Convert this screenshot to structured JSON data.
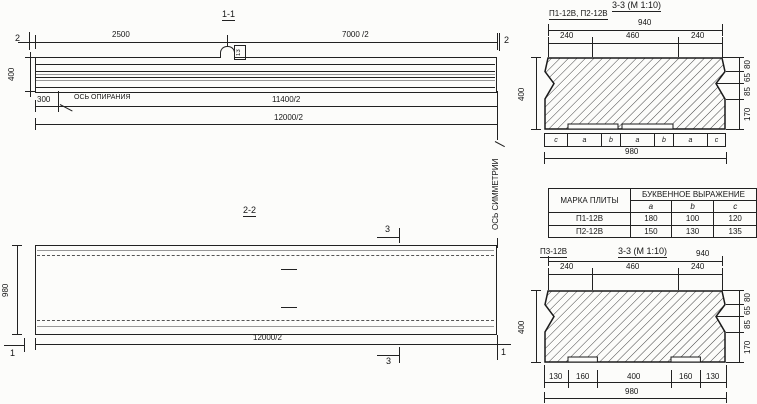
{
  "s11": {
    "title": "1-1",
    "dim_2500": "2500",
    "dim_7000": "7000 /2",
    "dim_400": "400",
    "dim_300": "300",
    "support_axis": "ОСЬ ОПИРАНИЯ",
    "dim_11400": "11400/2",
    "dim_12000": "12000/2",
    "marker_left": "2",
    "marker_right": "2",
    "loop_tag": "13",
    "symmetry_axis": "ОСЬ СИММЕТРИИ"
  },
  "s22": {
    "title": "2-2",
    "dim_980": "980",
    "dim_12000": "12000/2",
    "marker_3": "3",
    "marker_1": "1"
  },
  "s33a": {
    "title": "3-3 (М 1:10)",
    "label": "П1-12В, П2-12В",
    "dim_940": "940",
    "dims_top": [
      "240",
      "460",
      "240"
    ],
    "dim_400": "400",
    "dims_right": [
      "80",
      "65",
      "85",
      "170"
    ],
    "letters": [
      "c",
      "a",
      "b",
      "a",
      "b",
      "a",
      "c"
    ],
    "dim_980": "980"
  },
  "table": {
    "header_mark": "МАРКА ПЛИТЫ",
    "header_expr": "БУКВЕННОЕ ВЫРАЖЕНИЕ",
    "cols": [
      "a",
      "b",
      "c"
    ],
    "rows": [
      {
        "mark": "П1-12В",
        "a": "180",
        "b": "100",
        "c": "120"
      },
      {
        "mark": "П2-12В",
        "a": "150",
        "b": "130",
        "c": "135"
      }
    ]
  },
  "s33b": {
    "label": "П3-12В",
    "title": "3-3 (М 1:10)",
    "dim_940": "940",
    "dims_top": [
      "240",
      "460",
      "240"
    ],
    "dim_400": "400",
    "dims_right": [
      "80",
      "65",
      "85",
      "170"
    ],
    "dims_bottom": [
      "130",
      "160",
      "400",
      "160",
      "130"
    ],
    "dim_980": "980"
  }
}
